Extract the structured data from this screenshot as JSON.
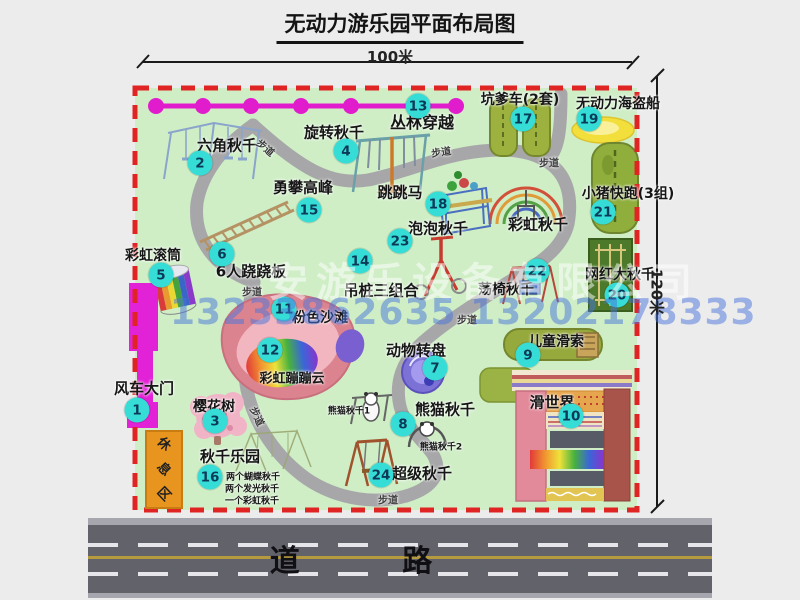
{
  "title": "无动力游乐园平面布局图",
  "dimensions": {
    "top": "100米",
    "right": "120米"
  },
  "road": {
    "label": "道 路"
  },
  "watermark": {
    "company": "安游乐设备有限公司",
    "phone": "13233862635 13202178333"
  },
  "rest_area": {
    "label": "休息区"
  },
  "colors": {
    "badge": "#36dcd6",
    "border": "#e02424",
    "magenta": "#e11ccc",
    "map_bg": "#cfeec6",
    "road": "#62626a"
  },
  "map": {
    "labels": [
      {
        "id": "jungle-crossing",
        "text": "丛林穿越",
        "x": 422,
        "y": 121,
        "size": 16
      },
      {
        "id": "hexagon-swing",
        "text": "六角秋千",
        "x": 227,
        "y": 145,
        "size": 15
      },
      {
        "id": "rotating-swing",
        "text": "旋转秋千",
        "x": 334,
        "y": 132,
        "size": 15
      },
      {
        "id": "climbing-peak",
        "text": "勇攀高峰",
        "x": 303,
        "y": 187,
        "size": 15
      },
      {
        "id": "jumping-horse",
        "text": "跳跳马",
        "x": 400,
        "y": 192,
        "size": 15
      },
      {
        "id": "pit-car",
        "text": "坑爹车(2套)",
        "x": 520,
        "y": 99,
        "size": 14
      },
      {
        "id": "pirate-ship",
        "text": "无动力海盗船",
        "x": 618,
        "y": 103,
        "size": 14
      },
      {
        "id": "piggy-run",
        "text": "小猪快跑(3组)",
        "x": 628,
        "y": 193,
        "size": 14
      },
      {
        "id": "rainbow-swing",
        "text": "彩虹秋千",
        "x": 538,
        "y": 224,
        "size": 15
      },
      {
        "id": "bubble-swing",
        "text": "泡泡秋千",
        "x": 438,
        "y": 228,
        "size": 15
      },
      {
        "id": "chair-swing",
        "text": "荡椅秋千",
        "x": 506,
        "y": 289,
        "size": 14
      },
      {
        "id": "net-swing",
        "text": "网红大秋千",
        "x": 620,
        "y": 274,
        "size": 14
      },
      {
        "id": "rainbow-roller",
        "text": "彩虹滚筒",
        "x": 153,
        "y": 255,
        "size": 14
      },
      {
        "id": "seesaw-6p",
        "text": "6人跷跷板",
        "x": 251,
        "y": 271,
        "size": 15
      },
      {
        "id": "pile-combo",
        "text": "吊桩三组合",
        "x": 381,
        "y": 290,
        "size": 15
      },
      {
        "id": "pink-beach",
        "text": "粉色沙滩",
        "x": 320,
        "y": 317,
        "size": 14
      },
      {
        "id": "bouncing-cloud",
        "text": "彩虹蹦蹦云",
        "x": 292,
        "y": 377,
        "size": 13
      },
      {
        "id": "animal-carousel",
        "text": "动物转盘",
        "x": 416,
        "y": 350,
        "size": 15
      },
      {
        "id": "kids-zipline",
        "text": "儿童滑索",
        "x": 556,
        "y": 341,
        "size": 14
      },
      {
        "id": "slide-world",
        "text": "滑世界",
        "x": 552,
        "y": 402,
        "size": 15
      },
      {
        "id": "windmill-gate",
        "text": "风车大门",
        "x": 144,
        "y": 388,
        "size": 15
      },
      {
        "id": "cherry-tree",
        "text": "樱花树",
        "x": 214,
        "y": 406,
        "size": 14
      },
      {
        "id": "swing-park",
        "text": "秋千乐园",
        "x": 230,
        "y": 456,
        "size": 15
      },
      {
        "id": "panda-swing",
        "text": "熊猫秋千",
        "x": 445,
        "y": 409,
        "size": 15
      },
      {
        "id": "panda-swing-1",
        "text": "熊猫秋千1",
        "x": 349,
        "y": 410,
        "size": 9
      },
      {
        "id": "panda-swing-2",
        "text": "熊猫秋千2",
        "x": 441,
        "y": 446,
        "size": 9
      },
      {
        "id": "super-swing",
        "text": "超级秋千",
        "x": 422,
        "y": 473,
        "size": 15
      },
      {
        "id": "swing-note-1",
        "text": "两个蝴蝶秋千",
        "x": 253,
        "y": 476,
        "size": 9
      },
      {
        "id": "swing-note-2",
        "text": "两个发光秋千",
        "x": 252,
        "y": 488,
        "size": 9
      },
      {
        "id": "swing-note-3",
        "text": "一个彩虹秋千",
        "x": 252,
        "y": 500,
        "size": 9
      },
      {
        "id": "trail-1",
        "text": "步道",
        "x": 266,
        "y": 147,
        "size": 10,
        "rot": 40,
        "trail": true
      },
      {
        "id": "trail-2",
        "text": "步道",
        "x": 441,
        "y": 151,
        "size": 10,
        "rot": -8,
        "trail": true
      },
      {
        "id": "trail-3",
        "text": "步道",
        "x": 549,
        "y": 162,
        "size": 10,
        "rot": 0,
        "trail": true
      },
      {
        "id": "trail-4",
        "text": "步道",
        "x": 252,
        "y": 291,
        "size": 10,
        "rot": 0,
        "trail": true
      },
      {
        "id": "trail-5",
        "text": "步道",
        "x": 467,
        "y": 319,
        "size": 10,
        "rot": 0,
        "trail": true
      },
      {
        "id": "trail-6",
        "text": "步道",
        "x": 258,
        "y": 416,
        "size": 10,
        "rot": 65,
        "trail": true
      },
      {
        "id": "trail-7",
        "text": "步道",
        "x": 388,
        "y": 499,
        "size": 10,
        "rot": 0,
        "trail": true
      }
    ],
    "badges": [
      {
        "n": "1",
        "x": 137,
        "y": 410
      },
      {
        "n": "2",
        "x": 200,
        "y": 163
      },
      {
        "n": "3",
        "x": 215,
        "y": 421
      },
      {
        "n": "4",
        "x": 346,
        "y": 151
      },
      {
        "n": "5",
        "x": 161,
        "y": 275
      },
      {
        "n": "6",
        "x": 222,
        "y": 254
      },
      {
        "n": "7",
        "x": 435,
        "y": 368
      },
      {
        "n": "8",
        "x": 403,
        "y": 424
      },
      {
        "n": "9",
        "x": 528,
        "y": 355
      },
      {
        "n": "10",
        "x": 571,
        "y": 416
      },
      {
        "n": "11",
        "x": 284,
        "y": 309
      },
      {
        "n": "12",
        "x": 270,
        "y": 350
      },
      {
        "n": "13",
        "x": 418,
        "y": 106
      },
      {
        "n": "14",
        "x": 360,
        "y": 261
      },
      {
        "n": "15",
        "x": 309,
        "y": 210
      },
      {
        "n": "16",
        "x": 210,
        "y": 477
      },
      {
        "n": "17",
        "x": 523,
        "y": 119
      },
      {
        "n": "18",
        "x": 438,
        "y": 204
      },
      {
        "n": "19",
        "x": 589,
        "y": 119
      },
      {
        "n": "20",
        "x": 617,
        "y": 295
      },
      {
        "n": "21",
        "x": 603,
        "y": 212
      },
      {
        "n": "22",
        "x": 537,
        "y": 271
      },
      {
        "n": "23",
        "x": 400,
        "y": 241
      },
      {
        "n": "24",
        "x": 381,
        "y": 475
      }
    ]
  }
}
